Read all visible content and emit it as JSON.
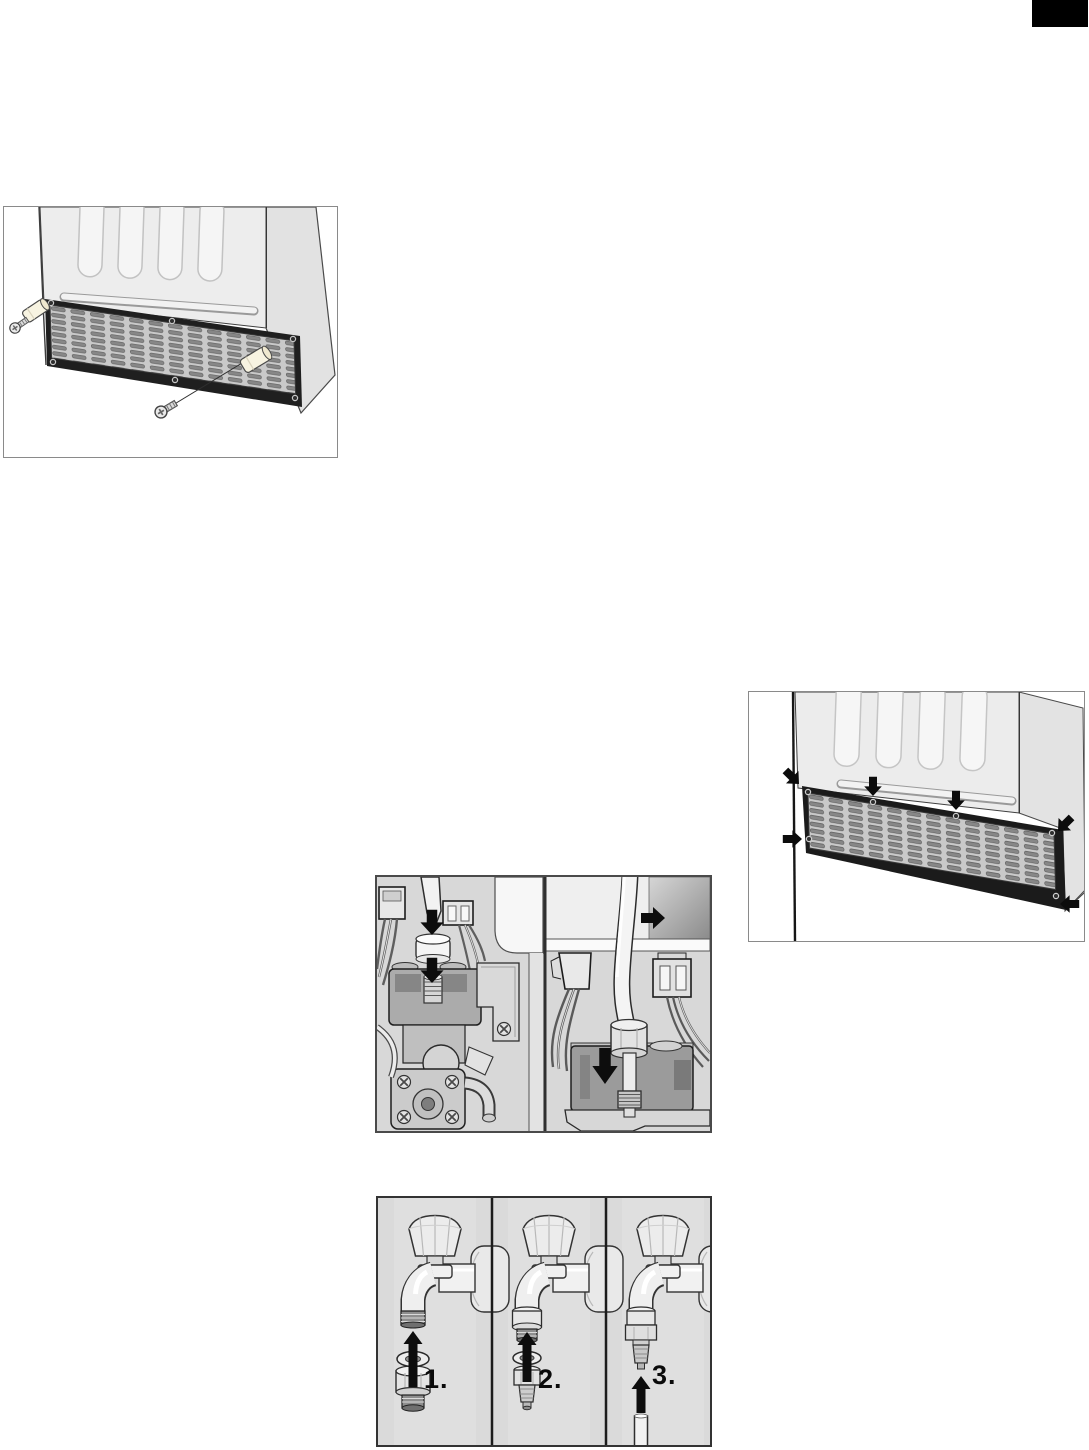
{
  "page": {
    "background_color": "#ffffff",
    "corner_tab_color": "#000000"
  },
  "figures": {
    "grille_removal": {
      "alt": "ventilation-grille-removal"
    },
    "grille_mounting": {
      "alt": "ventilation-grille-mounting"
    },
    "valve_hose": {
      "alt": "water-valve-hose-connection"
    },
    "faucet_adapter": {
      "alt": "faucet-adapter-installation",
      "steps": {
        "s1": "1.",
        "s2": "2.",
        "s3": "3."
      }
    }
  },
  "colors": {
    "figure_border": "#4a4a4a",
    "panel_background": "#d8d8d8",
    "arrow": "#0d0d0d"
  }
}
